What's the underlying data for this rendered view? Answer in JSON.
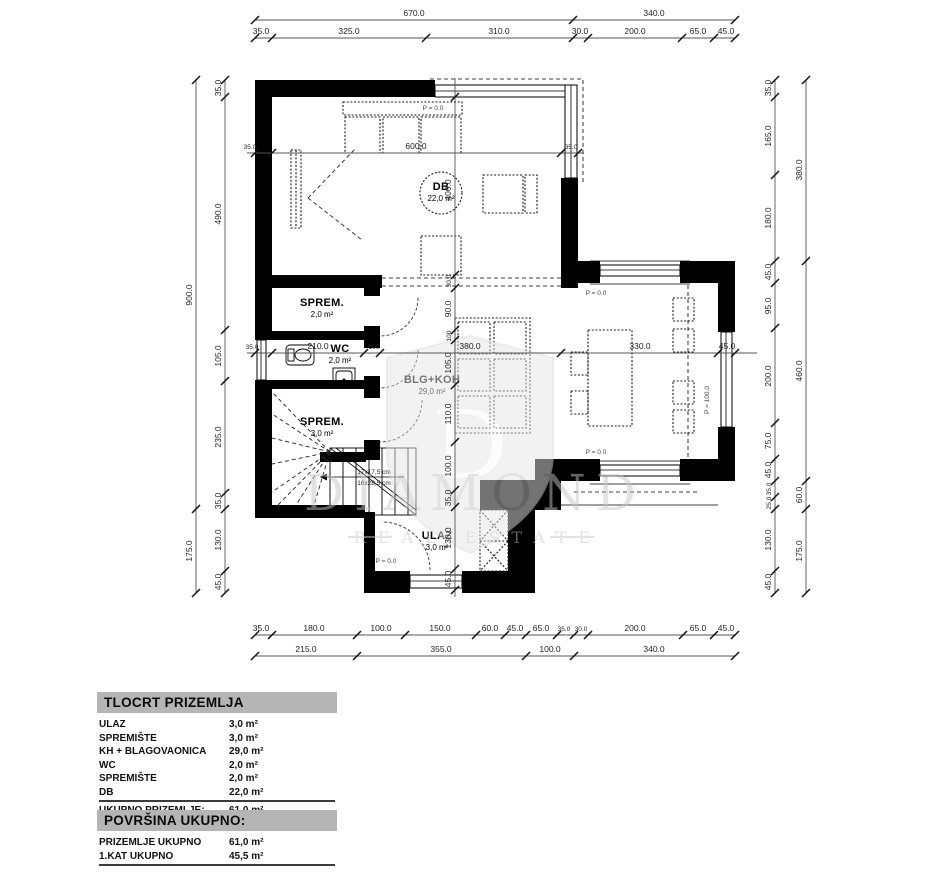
{
  "plan": {
    "rooms": {
      "db": {
        "name": "DB",
        "area": "22,0 m²"
      },
      "sprem2": {
        "name": "SPREM.",
        "area": "2,0 m²"
      },
      "wc": {
        "name": "WC",
        "area": "2,0 m²"
      },
      "sprem3": {
        "name": "SPREM.",
        "area": "3,0 m²"
      },
      "blg": {
        "name": "BLG+KOH",
        "area": "29,0 m²"
      },
      "ulaz": {
        "name": "ULAZ",
        "area": "3,0 m²"
      }
    },
    "levels": {
      "p0": "P = 0.0",
      "p100": "P = 100.0"
    },
    "stairs": {
      "riser": "17x17,5 cm",
      "tread": "16x28,5 cm"
    }
  },
  "dims": {
    "top_outer": [
      "670.0",
      "340.0"
    ],
    "top_inner": [
      "35.0",
      "325.0",
      "310.0",
      "30.0",
      "200.0",
      "65.0",
      "45.0"
    ],
    "left_outer": [
      "900.0",
      "175.0"
    ],
    "left_inner": [
      "35.0",
      "490.0",
      "105.0",
      "235.0",
      "35.0",
      "130.0",
      "45.0"
    ],
    "right_outer": [
      "380.0",
      "460.0",
      "60.0",
      "175.0"
    ],
    "right_inner": [
      "35.0",
      "165.0",
      "180.0",
      "45.0",
      "95.0",
      "200.0",
      "75.0",
      "45.0",
      "35.0",
      "25.0",
      "130.0",
      "45.0"
    ],
    "bottom_inner": [
      "35.0",
      "180.0",
      "100.0",
      "150.0",
      "60.0",
      "45.0",
      "65.0",
      "35.0",
      "30.0",
      "200.0",
      "65.0",
      "45.0"
    ],
    "bottom_outer": [
      "215.0",
      "355.0",
      "100.0",
      "340.0"
    ],
    "inner_h1": [
      "35.0",
      "600.0",
      "35.0"
    ],
    "inner_h2": [
      "35.0",
      "210.0",
      "100",
      "380.0",
      "330.0",
      "45.0"
    ],
    "inner_v": [
      "400.0",
      "30.0",
      "90.0",
      "100",
      "105.0",
      "110.0",
      "100.0",
      "35.0",
      "130.0",
      "45.0"
    ]
  },
  "watermark": {
    "word": "DIAMOND",
    "sub": "REAL ESTATE",
    "initial": "D"
  },
  "legend": {
    "title": "TLOCRT PRIZEMLJA",
    "rows": [
      {
        "label": "ULAZ",
        "value": "3,0 m²"
      },
      {
        "label": "SPREMIŠTE",
        "value": "3,0 m²"
      },
      {
        "label": "KH + BLAGOVAONICA",
        "value": "29,0 m²"
      },
      {
        "label": "WC",
        "value": "2,0 m²"
      },
      {
        "label": "SPREMIŠTE",
        "value": "2,0 m²"
      },
      {
        "label": "DB",
        "value": "22,0 m²"
      }
    ],
    "total": {
      "label": "UKUPNO PRIZEMLJE:",
      "value": "61,0 m²"
    }
  },
  "totals": {
    "title": "POVRŠINA UKUPNO:",
    "rows": [
      {
        "label": "PRIZEMLJE UKUPNO",
        "value": "61,0 m²"
      },
      {
        "label": "1.KAT UKUPNO",
        "value": "45,5 m²"
      }
    ],
    "net": {
      "label": "UKUPNO NETO",
      "value": "106,5 m²"
    }
  }
}
